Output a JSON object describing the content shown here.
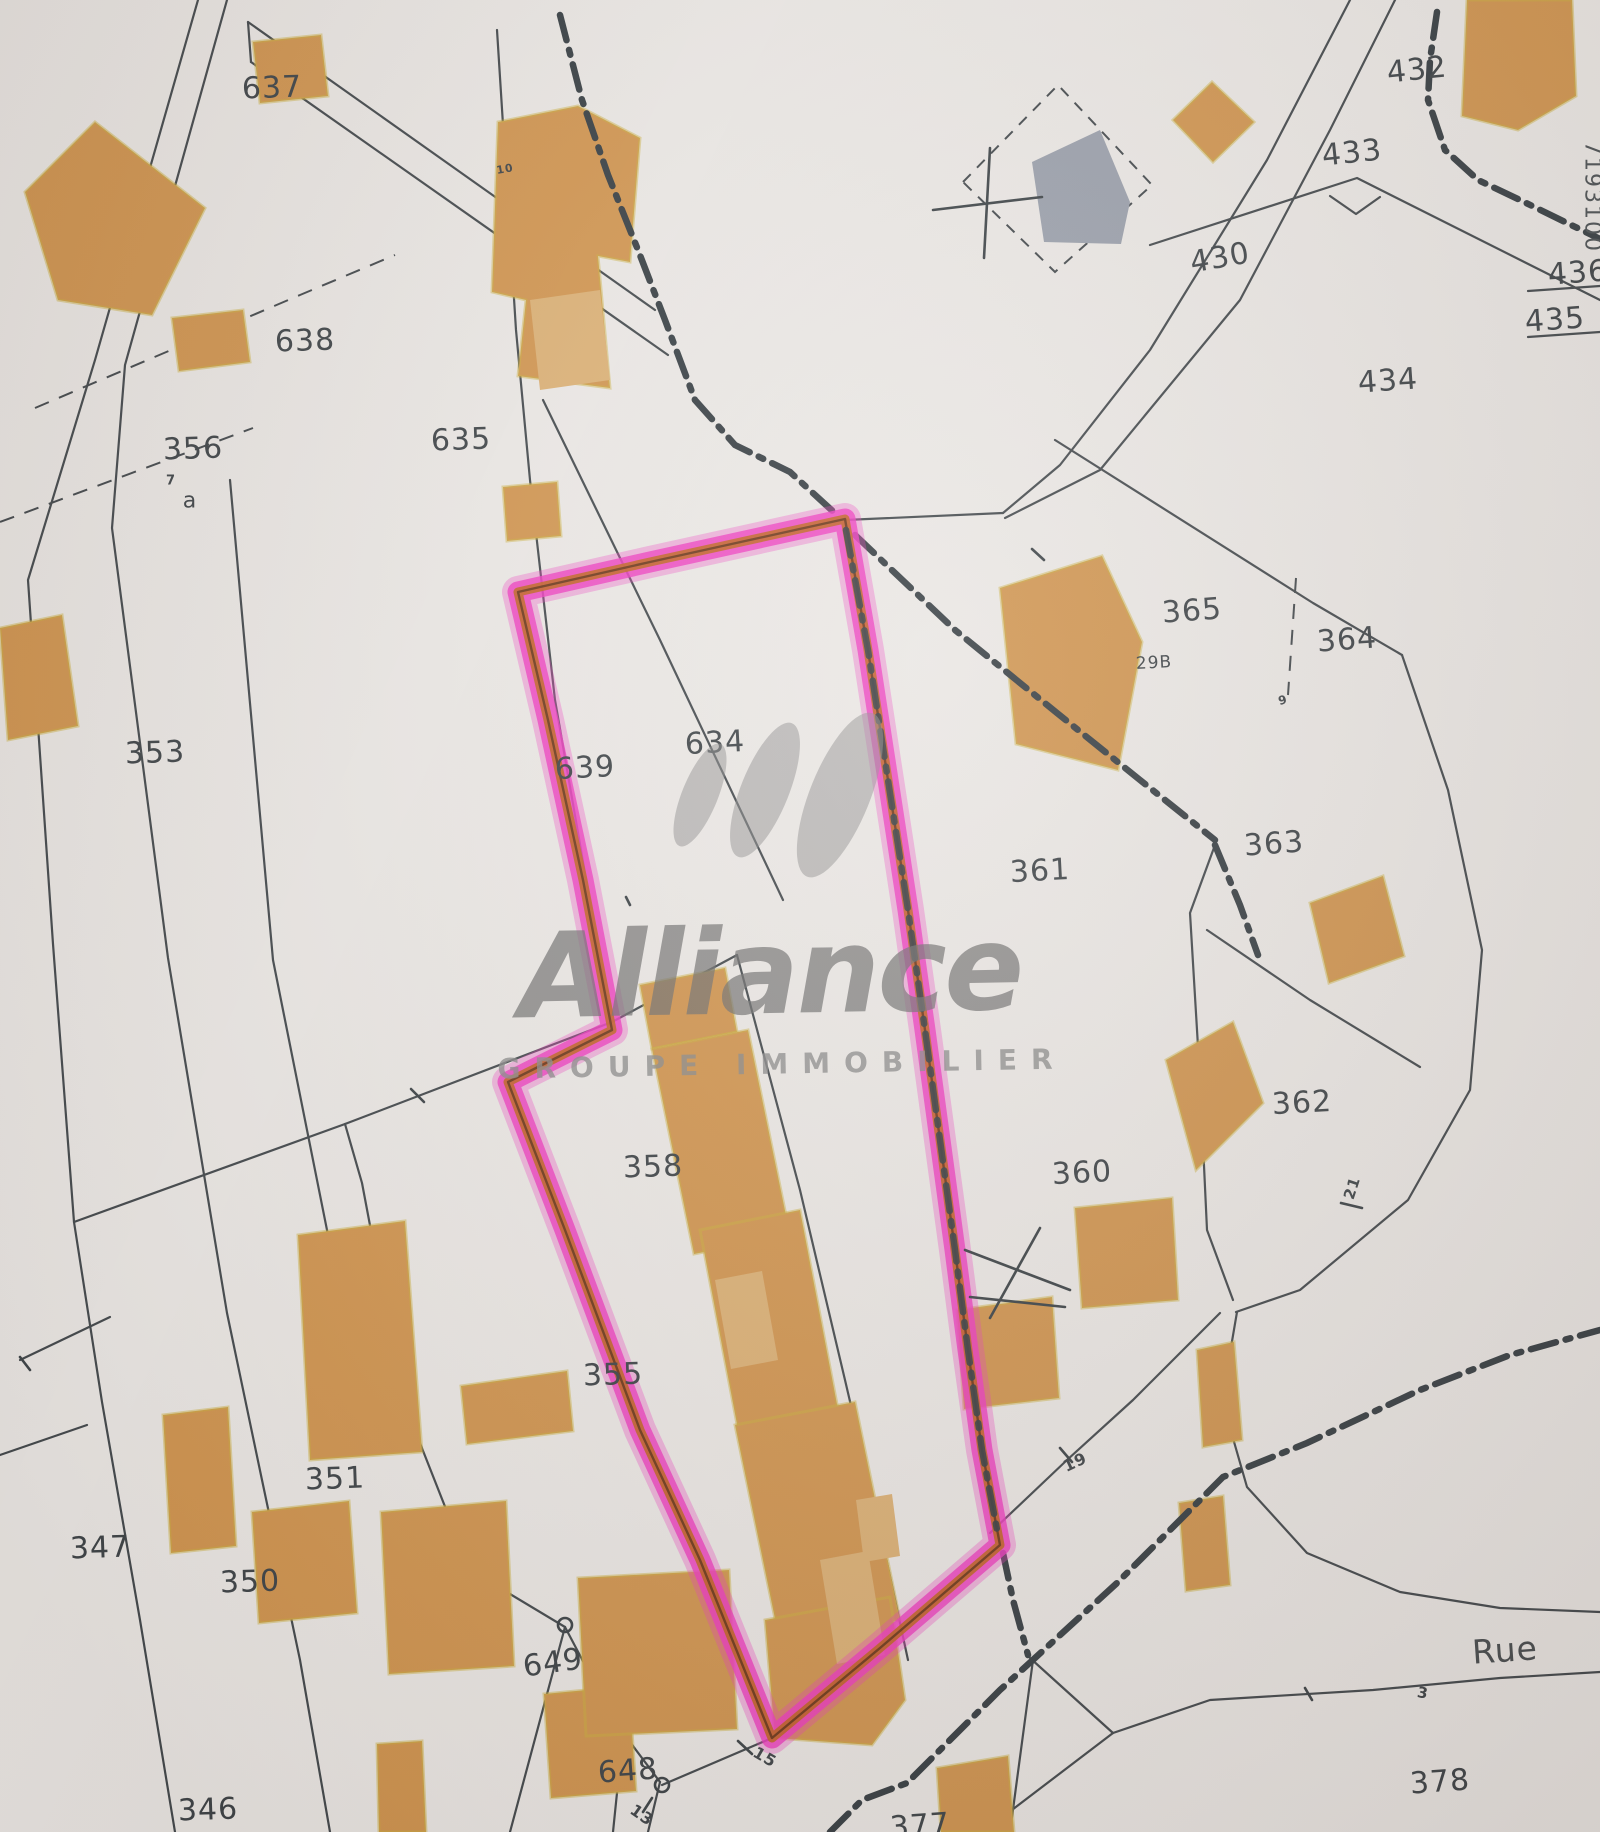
{
  "map": {
    "type": "cadastral-plan-photo",
    "paper_color": "#edeae7",
    "line_color": "#41474b",
    "building_color": "#d2954e",
    "building_light_color": "#ddb174",
    "gray_building_color": "#9aa0ac",
    "highlight_pink": "#f03ac0",
    "highlight_inner_orange": "#c0631d",
    "watermark": {
      "title": "Alliance",
      "subtitle": "GROUPE IMMOBILIER",
      "color": "#6e6e6e"
    },
    "labels": [
      {
        "t": "637",
        "x": 272,
        "y": 88,
        "s": 30,
        "r": -2,
        "c": "parcel"
      },
      {
        "t": "638",
        "x": 305,
        "y": 341,
        "s": 30,
        "r": -2,
        "c": "parcel"
      },
      {
        "t": "635",
        "x": 461,
        "y": 440,
        "s": 30,
        "r": -2,
        "c": "parcel"
      },
      {
        "t": "356",
        "x": 193,
        "y": 449,
        "s": 30,
        "r": -2,
        "c": "parcel"
      },
      {
        "t": "7",
        "x": 171,
        "y": 481,
        "s": 13,
        "r": 0,
        "c": "small"
      },
      {
        "t": "a",
        "x": 190,
        "y": 501,
        "s": 22,
        "r": 0,
        "c": "sub"
      },
      {
        "t": "10",
        "x": 505,
        "y": 169,
        "s": 11,
        "r": -10,
        "c": "small"
      },
      {
        "t": "353",
        "x": 155,
        "y": 753,
        "s": 30,
        "r": -2,
        "c": "parcel"
      },
      {
        "t": "639",
        "x": 585,
        "y": 768,
        "s": 30,
        "r": -3,
        "c": "parcel"
      },
      {
        "t": "634",
        "x": 715,
        "y": 743,
        "s": 30,
        "r": -3,
        "c": "parcel"
      },
      {
        "t": "432",
        "x": 1417,
        "y": 70,
        "s": 30,
        "r": -6,
        "c": "parcel"
      },
      {
        "t": "433",
        "x": 1352,
        "y": 153,
        "s": 30,
        "r": -6,
        "c": "parcel"
      },
      {
        "t": "430",
        "x": 1220,
        "y": 258,
        "s": 30,
        "r": -10,
        "c": "parcel"
      },
      {
        "t": "436",
        "x": 1578,
        "y": 273,
        "s": 30,
        "r": -4,
        "c": "parcel"
      },
      {
        "t": "435",
        "x": 1555,
        "y": 320,
        "s": 30,
        "r": -4,
        "c": "parcel"
      },
      {
        "t": "434",
        "x": 1388,
        "y": 381,
        "s": 30,
        "r": -4,
        "c": "parcel"
      },
      {
        "t": "7193100",
        "x": 1592,
        "y": 197,
        "s": 22,
        "r": 90,
        "c": "coord"
      },
      {
        "t": "365",
        "x": 1192,
        "y": 611,
        "s": 30,
        "r": -4,
        "c": "parcel"
      },
      {
        "t": "29B",
        "x": 1154,
        "y": 663,
        "s": 17,
        "r": -3,
        "c": "sub"
      },
      {
        "t": "364",
        "x": 1347,
        "y": 640,
        "s": 30,
        "r": -4,
        "c": "parcel"
      },
      {
        "t": "363",
        "x": 1274,
        "y": 844,
        "s": 30,
        "r": -4,
        "c": "parcel"
      },
      {
        "t": "361",
        "x": 1040,
        "y": 871,
        "s": 30,
        "r": -3,
        "c": "parcel"
      },
      {
        "t": "9",
        "x": 1283,
        "y": 700,
        "s": 12,
        "r": -15,
        "c": "small"
      },
      {
        "t": "362",
        "x": 1302,
        "y": 1103,
        "s": 30,
        "r": -3,
        "c": "parcel"
      },
      {
        "t": "360",
        "x": 1082,
        "y": 1173,
        "s": 30,
        "r": -3,
        "c": "parcel"
      },
      {
        "t": "358",
        "x": 653,
        "y": 1167,
        "s": 30,
        "r": -2,
        "c": "parcel"
      },
      {
        "t": "355",
        "x": 613,
        "y": 1375,
        "s": 30,
        "r": -2,
        "c": "parcel"
      },
      {
        "t": "351",
        "x": 335,
        "y": 1479,
        "s": 30,
        "r": -2,
        "c": "parcel"
      },
      {
        "t": "347",
        "x": 100,
        "y": 1548,
        "s": 30,
        "r": -2,
        "c": "parcel"
      },
      {
        "t": "350",
        "x": 250,
        "y": 1582,
        "s": 30,
        "r": -2,
        "c": "parcel"
      },
      {
        "t": "649",
        "x": 553,
        "y": 1663,
        "s": 30,
        "r": -8,
        "c": "parcel"
      },
      {
        "t": "648",
        "x": 628,
        "y": 1771,
        "s": 30,
        "r": -4,
        "c": "parcel"
      },
      {
        "t": "346",
        "x": 208,
        "y": 1810,
        "s": 30,
        "r": -2,
        "c": "parcel"
      },
      {
        "t": "377",
        "x": 920,
        "y": 1826,
        "s": 30,
        "r": -4,
        "c": "parcel"
      },
      {
        "t": "378",
        "x": 1440,
        "y": 1782,
        "s": 30,
        "r": -4,
        "c": "parcel"
      },
      {
        "t": "Rue",
        "x": 1505,
        "y": 1650,
        "s": 33,
        "r": -4,
        "c": "street"
      },
      {
        "t": "19",
        "x": 1075,
        "y": 1462,
        "s": 16,
        "r": -25,
        "c": "small"
      },
      {
        "t": "21",
        "x": 1352,
        "y": 1188,
        "s": 15,
        "r": -72,
        "c": "small"
      },
      {
        "t": "15",
        "x": 765,
        "y": 1757,
        "s": 16,
        "r": 30,
        "c": "small"
      },
      {
        "t": "13",
        "x": 642,
        "y": 1815,
        "s": 16,
        "r": 35,
        "c": "small"
      },
      {
        "t": "3",
        "x": 1423,
        "y": 1693,
        "s": 15,
        "r": 10,
        "c": "small"
      }
    ]
  }
}
